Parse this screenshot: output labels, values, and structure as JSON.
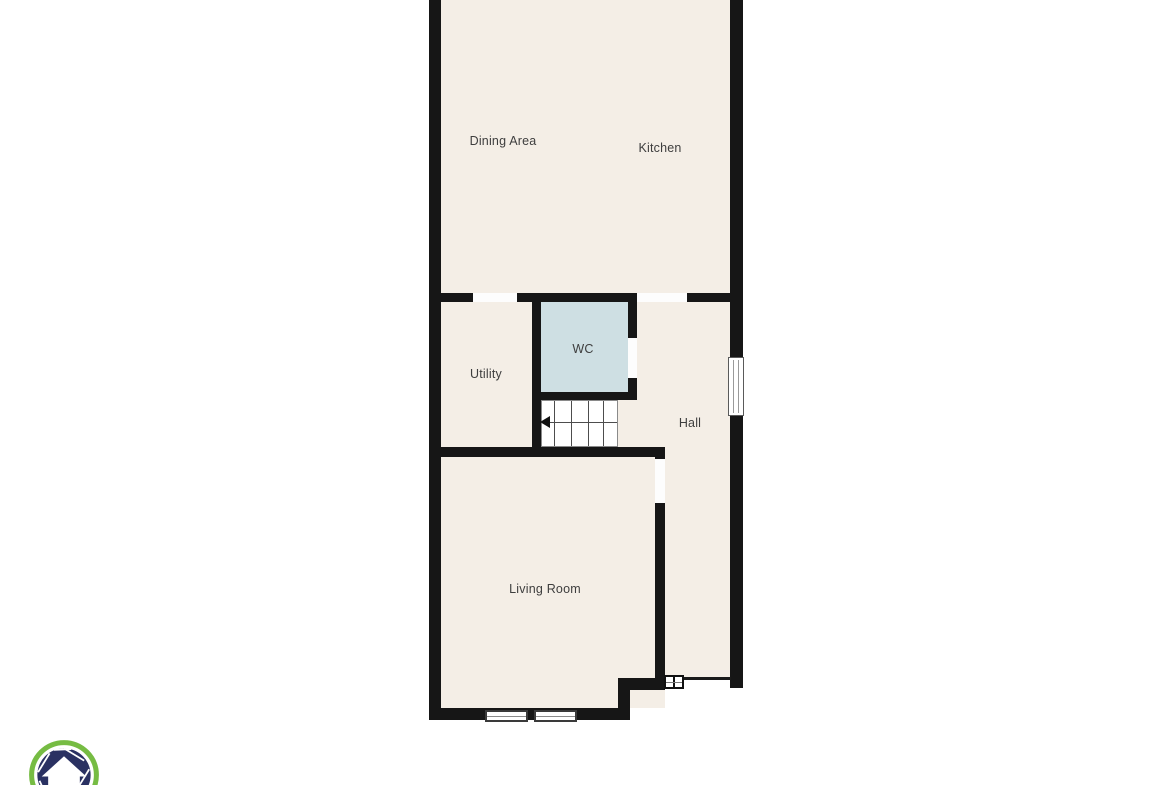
{
  "floorplan": {
    "type": "floor-plan",
    "colors": {
      "floor": "#f4eee6",
      "wall": "#161616",
      "wc_floor": "#cedfe3",
      "label_text": "#3e3e3e",
      "outside": "#ffffff"
    },
    "rooms": [
      {
        "id": "dining-area",
        "label": "Dining Area"
      },
      {
        "id": "kitchen",
        "label": "Kitchen"
      },
      {
        "id": "utility",
        "label": "Utility"
      },
      {
        "id": "wc",
        "label": "WC"
      },
      {
        "id": "hall",
        "label": "Hall"
      },
      {
        "id": "living-room",
        "label": "Living Room"
      }
    ],
    "features": {
      "stairs": "staircase with left-pointing direction arrow, 5 treads",
      "windows": [
        "living-room bottom window pair",
        "hall right-side window"
      ],
      "doors": [
        "utility doorway",
        "kitchen-hall doorway",
        "wc doorway",
        "living-room doorway",
        "hall small double door"
      ]
    }
  },
  "logo": {
    "name": "aperture-house-logo",
    "ring_color": "#76bc43",
    "blade_color": "#2a3162",
    "house_color": "#ffffff"
  }
}
